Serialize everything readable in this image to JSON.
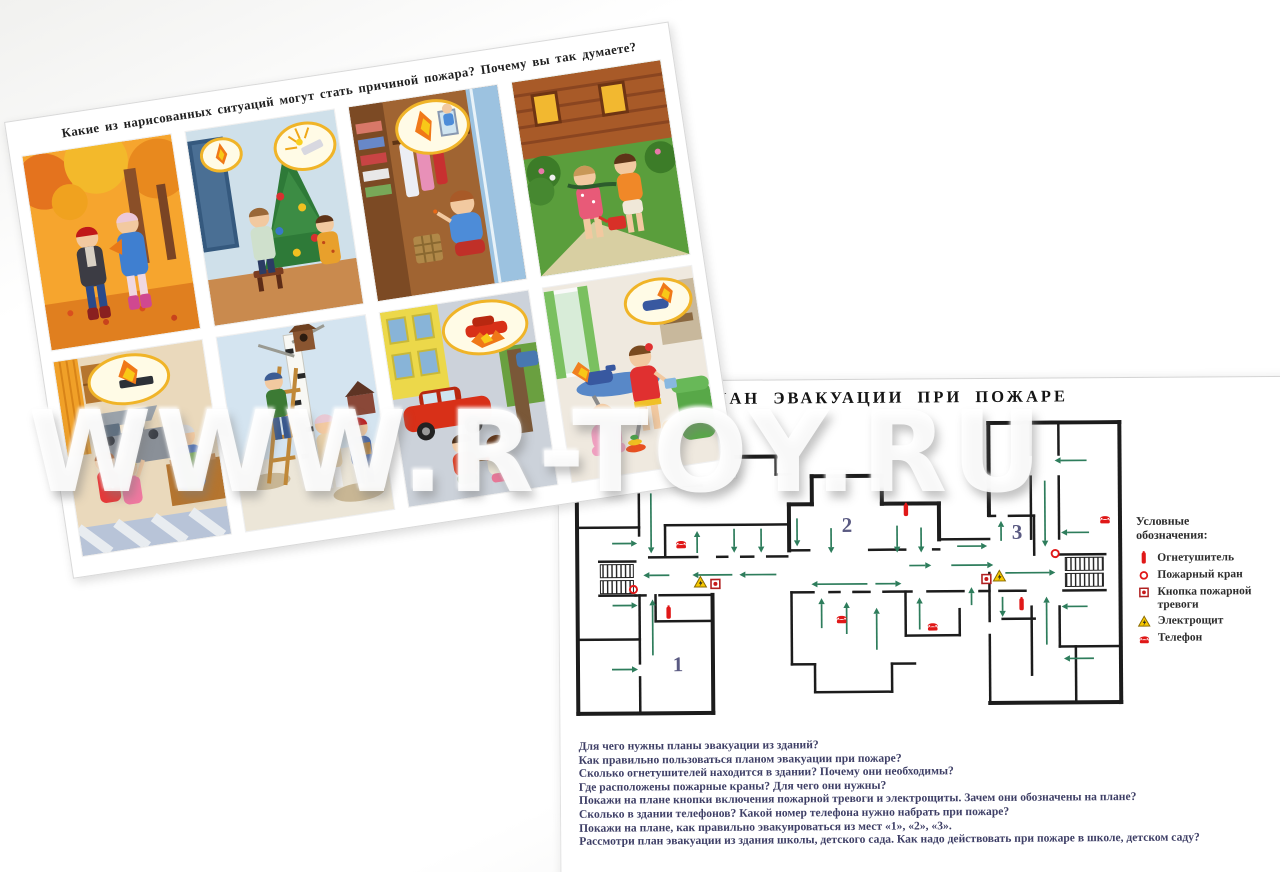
{
  "watermark": {
    "text": "WWW.R-TOY.RU"
  },
  "situations_card": {
    "title": "Какие из нарисованных ситуаций могут стать причиной пожара? Почему вы так думаете?",
    "pictures": [
      {
        "name": "autumn-leaves",
        "desc": "Дети собирают осенние листья в парке"
      },
      {
        "name": "christmas-tree",
        "desc": "Дети наряжают ёлку, бенгальские огни"
      },
      {
        "name": "wardrobe-matches",
        "desc": "Мальчик играет со спичками в шкафу"
      },
      {
        "name": "garden-watering",
        "desc": "Дети поливают цветы у деревянного дома"
      },
      {
        "name": "kitchen-stove",
        "desc": "Девочки тянутся к плите на кухне"
      },
      {
        "name": "birdhouse",
        "desc": "Дети вешают скворечник на берёзу"
      },
      {
        "name": "car-matches",
        "desc": "Дети играют со спичками возле машины"
      },
      {
        "name": "iron-baby",
        "desc": "Девочка играет с утюгом рядом с малышом"
      }
    ]
  },
  "plan_card": {
    "title": "ПЛАН ЭВАКУАЦИИ ПРИ ПОЖАРЕ",
    "legend": {
      "heading": [
        "Условные",
        "обозначения:"
      ],
      "items": [
        {
          "icon": "extinguisher",
          "label": "Огнетушитель"
        },
        {
          "icon": "hydrant",
          "label": "Пожарный кран"
        },
        {
          "icon": "alarm-button",
          "label": "Кнопка пожарной тревоги"
        },
        {
          "icon": "electro",
          "label": "Электрощит"
        },
        {
          "icon": "phone",
          "label": "Телефон"
        }
      ]
    },
    "questions": [
      "Для чего нужны планы эвакуации из зданий?",
      "Как правильно пользоваться планом эвакуации при пожаре?",
      "Сколько огнетушителей находится в здании? Почему они необходимы?",
      "Где расположены пожарные краны? Для чего они нужны?",
      "Покажи на плане кнопки включения пожарной тревоги и электрощиты. Зачем они обозначены на плане?",
      "Сколько в здании телефонов? Какой номер телефона нужно набрать при пожаре?",
      "Покажи на плане, как правильно эвакуироваться из мест «1», «2», «3».",
      "Рассмотри план эвакуации из здания школы, детского сада. Как надо действовать при пожаре в школе, детском саду?"
    ],
    "plan": {
      "wall_color": "#1c1c1c",
      "arrow_color": "#2e7d5c",
      "zones": [
        {
          "label": "1",
          "x": 108,
          "y": 248
        },
        {
          "label": "2",
          "x": 278,
          "y": 110
        },
        {
          "label": "3",
          "x": 448,
          "y": 118
        }
      ],
      "walls": [
        [
          8,
          62,
          8,
          290,
          4
        ],
        [
          8,
          290,
          143,
          290,
          4
        ],
        [
          143,
          290,
          143,
          172,
          4
        ],
        [
          8,
          62,
          70,
          62,
          4
        ],
        [
          79,
          62,
          132,
          62,
          4
        ],
        [
          132,
          62,
          132,
          34,
          4
        ],
        [
          132,
          34,
          207,
          34,
          4
        ],
        [
          243,
          54,
          313,
          54,
          4
        ],
        [
          243,
          54,
          243,
          82,
          4
        ],
        [
          313,
          54,
          313,
          82,
          4
        ],
        [
          243,
          82,
          220,
          82,
          4
        ],
        [
          220,
          82,
          220,
          128,
          4
        ],
        [
          313,
          82,
          370,
          82,
          4
        ],
        [
          370,
          82,
          370,
          118,
          4
        ],
        [
          420,
          2,
          551,
          2,
          4
        ],
        [
          551,
          2,
          551,
          282,
          4
        ],
        [
          420,
          282,
          551,
          282,
          4
        ],
        [
          420,
          2,
          420,
          94,
          4
        ],
        [
          207,
          34,
          207,
          52,
          2.5
        ],
        [
          207,
          52,
          222,
          52,
          2.5
        ],
        [
          8,
          104,
          70,
          104,
          2.5
        ],
        [
          96,
          102,
          218,
          102,
          2.5
        ],
        [
          96,
          102,
          96,
          134,
          2.5
        ],
        [
          70,
          62,
          70,
          112,
          2.5
        ],
        [
          70,
          46,
          70,
          54,
          2.5
        ],
        [
          30,
          138,
          66,
          138,
          2.5
        ],
        [
          30,
          172,
          66,
          172,
          2.5
        ],
        [
          8,
          216,
          70,
          216,
          2.5
        ],
        [
          70,
          172,
          70,
          240,
          2.5
        ],
        [
          70,
          254,
          70,
          290,
          2.5
        ],
        [
          86,
          172,
          86,
          198,
          2.5
        ],
        [
          86,
          198,
          143,
          198,
          2.5
        ],
        [
          80,
          134,
          128,
          134,
          2.5
        ],
        [
          148,
          134,
          158,
          134,
          2.5
        ],
        [
          172,
          134,
          184,
          134,
          2.5
        ],
        [
          198,
          134,
          218,
          134,
          2.5
        ],
        [
          220,
          128,
          240,
          128,
          2.5
        ],
        [
          300,
          128,
          336,
          128,
          2.5
        ],
        [
          364,
          128,
          370,
          128,
          2.5
        ],
        [
          370,
          118,
          420,
          118,
          2.5
        ],
        [
          66,
          172,
          76,
          172,
          2.5
        ],
        [
          90,
          172,
          143,
          172,
          2.5
        ],
        [
          222,
          170,
          244,
          170,
          2.5
        ],
        [
          260,
          170,
          270,
          170,
          2.5
        ],
        [
          284,
          170,
          300,
          170,
          2.5
        ],
        [
          314,
          170,
          342,
          170,
          2.5
        ],
        [
          358,
          170,
          394,
          170,
          2.5
        ],
        [
          410,
          170,
          420,
          170,
          2.5
        ],
        [
          222,
          170,
          222,
          242,
          2.5
        ],
        [
          222,
          242,
          245,
          242,
          2.5
        ],
        [
          245,
          242,
          245,
          270,
          2.5
        ],
        [
          245,
          270,
          322,
          270,
          2.5
        ],
        [
          322,
          242,
          322,
          270,
          2.5
        ],
        [
          322,
          242,
          345,
          242,
          2.5
        ],
        [
          336,
          170,
          336,
          214,
          2.5
        ],
        [
          336,
          214,
          390,
          214,
          2.5
        ],
        [
          390,
          188,
          390,
          214,
          2.5
        ],
        [
          420,
          95,
          426,
          95,
          2.5
        ],
        [
          440,
          95,
          465,
          95,
          2.5
        ],
        [
          465,
          95,
          465,
          134,
          2.5
        ],
        [
          462,
          2,
          462,
          34,
          2.5
        ],
        [
          462,
          56,
          462,
          118,
          2.5
        ],
        [
          490,
          2,
          490,
          34,
          2.5
        ],
        [
          490,
          56,
          490,
          118,
          2.5
        ],
        [
          490,
          134,
          536,
          134,
          2.5
        ],
        [
          420,
          152,
          420,
          200,
          2.5
        ],
        [
          420,
          214,
          420,
          282,
          2.5
        ],
        [
          430,
          170,
          456,
          170,
          2.5
        ],
        [
          494,
          170,
          536,
          170,
          2.5
        ],
        [
          462,
          186,
          462,
          254,
          2.5
        ],
        [
          490,
          186,
          490,
          226,
          2.5
        ],
        [
          490,
          226,
          551,
          226,
          2.5
        ],
        [
          506,
          226,
          506,
          282,
          2.5
        ],
        [
          433,
          198,
          465,
          198,
          2.5
        ]
      ],
      "stairs": [
        [
          31,
          141,
          33,
          13
        ],
        [
          31,
          157,
          33,
          13
        ],
        [
          496,
          137,
          38,
          13
        ],
        [
          496,
          153,
          38,
          13
        ]
      ],
      "arrows": [
        [
          42,
          54,
          68,
          54
        ],
        [
          82,
          70,
          82,
          130
        ],
        [
          43,
          120,
          68,
          120
        ],
        [
          100,
          152,
          74,
          152
        ],
        [
          163,
          152,
          123,
          152
        ],
        [
          207,
          152,
          170,
          152
        ],
        [
          43,
          182,
          68,
          182
        ],
        [
          83,
          232,
          83,
          176
        ],
        [
          42,
          246,
          68,
          246
        ],
        [
          128,
          130,
          128,
          108
        ],
        [
          165,
          106,
          165,
          130
        ],
        [
          192,
          106,
          192,
          130
        ],
        [
          228,
          96,
          228,
          124
        ],
        [
          262,
          106,
          262,
          131
        ],
        [
          328,
          104,
          328,
          131
        ],
        [
          352,
          106,
          352,
          131
        ],
        [
          340,
          144,
          362,
          144
        ],
        [
          382,
          144,
          424,
          144
        ],
        [
          298,
          162,
          242,
          162
        ],
        [
          306,
          162,
          332,
          162
        ],
        [
          252,
          206,
          252,
          176
        ],
        [
          277,
          212,
          277,
          180
        ],
        [
          307,
          228,
          307,
          186
        ],
        [
          350,
          208,
          350,
          176
        ],
        [
          402,
          184,
          402,
          166
        ],
        [
          388,
          125,
          418,
          125
        ],
        [
          518,
          40,
          486,
          40
        ],
        [
          476,
          60,
          476,
          126
        ],
        [
          432,
          120,
          432,
          100
        ],
        [
          520,
          112,
          492,
          112
        ],
        [
          436,
          152,
          486,
          152
        ],
        [
          433,
          176,
          433,
          196
        ],
        [
          477,
          224,
          477,
          176
        ],
        [
          518,
          186,
          492,
          186
        ],
        [
          524,
          238,
          494,
          238
        ]
      ],
      "symbols": [
        {
          "type": "phone",
          "x": 112,
          "y": 120
        },
        {
          "type": "phone",
          "x": 272,
          "y": 196
        },
        {
          "type": "phone",
          "x": 363,
          "y": 204
        },
        {
          "type": "phone",
          "x": 536,
          "y": 98
        },
        {
          "type": "hydrant",
          "x": 64,
          "y": 166
        },
        {
          "type": "hydrant",
          "x": 486,
          "y": 133
        },
        {
          "type": "extinguisher",
          "x": 99,
          "y": 190
        },
        {
          "type": "extinguisher",
          "x": 337,
          "y": 89
        },
        {
          "type": "extinguisher",
          "x": 452,
          "y": 184
        },
        {
          "type": "electro",
          "x": 131,
          "y": 159
        },
        {
          "type": "electro",
          "x": 430,
          "y": 155
        },
        {
          "type": "alarm-button",
          "x": 146,
          "y": 161
        },
        {
          "type": "alarm-button",
          "x": 417,
          "y": 158
        }
      ]
    }
  }
}
